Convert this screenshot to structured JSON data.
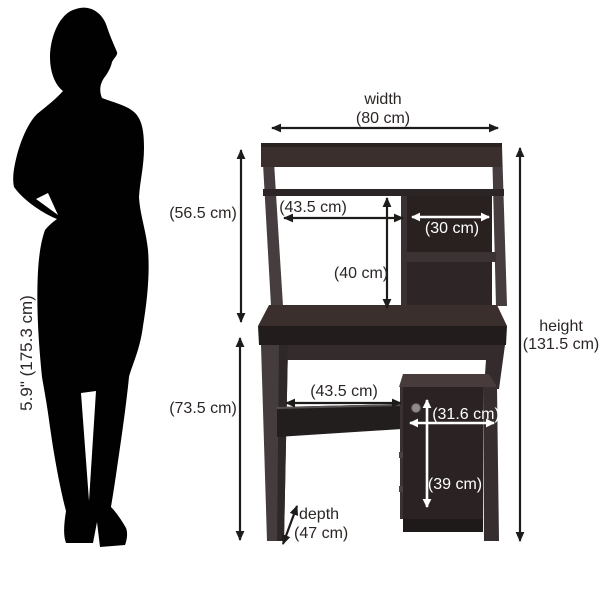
{
  "person": {
    "height_label": "5.9\" (175.3 cm)"
  },
  "desk": {
    "width_label": "width",
    "width_value": "(80 cm)",
    "height_label": "height",
    "height_value": "(131.5 cm)",
    "depth_label": "depth",
    "depth_value": "(47 cm)",
    "hutch_height_value": "(56.5 cm)",
    "hutch_opening_width_value": "(43.5 cm)",
    "hutch_opening_height_value": "(40 cm)",
    "hutch_shelf_width_value": "(30 cm)",
    "base_height_value": "(73.5 cm)",
    "base_opening_width_value": "(43.5 cm)",
    "cabinet_width_value": "(31.6 cm)",
    "cabinet_height_value": "(39 cm)"
  },
  "colors": {
    "background": "#ffffff",
    "silhouette": "#010101",
    "dimension_text": "#2b2624",
    "arrow_black": "#1e1c1b",
    "arrow_white": "#ffffff",
    "wood_rail": "#3b2f2d",
    "wood_interior": "#282120",
    "wood_front": "#221c1c",
    "wood_side": "#443c3d",
    "wood_top": "#3a2f2c",
    "wood_shelf": "#231e1e",
    "cabinet_top": "#473b3b",
    "cabinet_door": "#2a2223",
    "knob": "#918b8c"
  }
}
